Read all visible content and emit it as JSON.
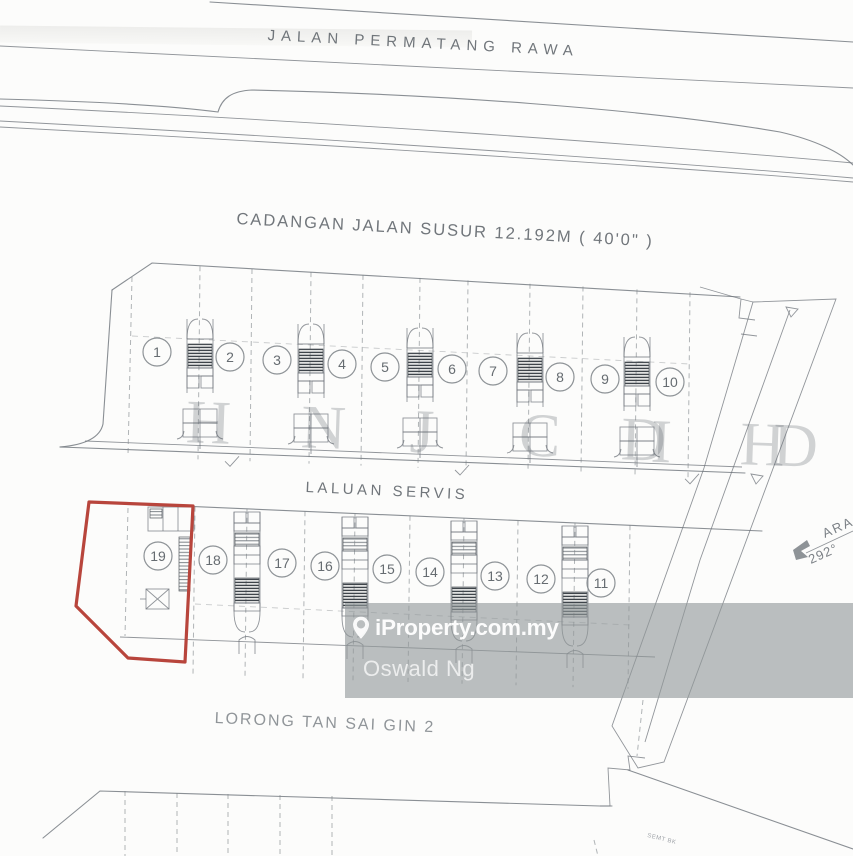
{
  "labels": {
    "top_road": "JALAN PERMATANG RAWA",
    "proposed_road": "CADANGAN JALAN SUSUR 12.192M ( 40'0\" )",
    "service_lane": "LALUAN SERVIS",
    "bottom_road": "LORONG TAN SAI GIN 2",
    "bearing_direction": "ARA",
    "bearing_value": "292°",
    "fine_print": "SEMT BK"
  },
  "lots": {
    "top_row": [
      "1",
      "2",
      "3",
      "4",
      "5",
      "6",
      "7",
      "8",
      "9",
      "10"
    ],
    "bottom_row": [
      "19",
      "18",
      "17",
      "16",
      "15",
      "14",
      "13",
      "12",
      "11"
    ]
  },
  "highlight": {
    "lot": "19",
    "color": "#b8453c"
  },
  "watermark": {
    "brand": "iProperty.com.my",
    "agent": "Oswald Ng",
    "pin_icon": "map-pin-icon",
    "band_color": "rgba(146,152,154,0.62)"
  },
  "ghost_stamp": {
    "letters": [
      "H",
      "N",
      "J",
      "C",
      "D",
      "I",
      "H",
      "D"
    ],
    "color": "rgba(95,100,106,0.28)"
  },
  "colors": {
    "plan_line": "#6d737a",
    "dash_line": "#7d8388",
    "text": "#5e646a"
  }
}
